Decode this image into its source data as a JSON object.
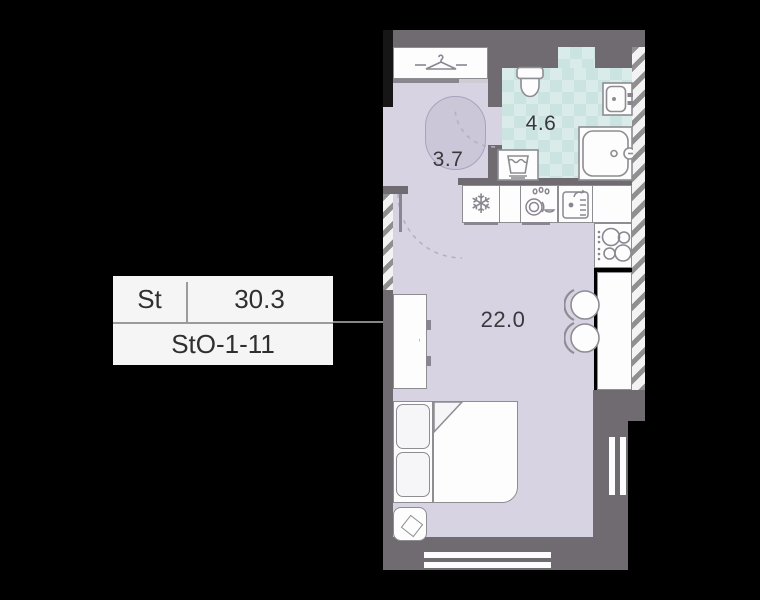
{
  "unit_card": {
    "type_label": "St",
    "area_value": "30.3",
    "unit_id": "StO-1-11"
  },
  "plan": {
    "rooms": [
      {
        "name": "hallway",
        "area_label": "3.7"
      },
      {
        "name": "bathroom",
        "area_label": "4.6"
      },
      {
        "name": "living-room",
        "area_label": "22.0"
      }
    ]
  },
  "icons": {
    "snowflake_glyph": "❄",
    "names": [
      "hanger-icon",
      "snowflake-icon",
      "dishwasher-icon",
      "kitchen-sink-icon",
      "toilet-icon",
      "bath-sink-icon",
      "bathtub-icon",
      "washing-machine-icon",
      "stove-burners-icon",
      "chair-icon",
      "rug",
      "bed",
      "pillow",
      "nightstand",
      "window"
    ]
  },
  "colors": {
    "floor": "#d7d3e3",
    "tile": "#d9ecea",
    "tile_check": "#cbe4e1",
    "wall_gray": "#6f6b70",
    "wall_black": "#161616",
    "outline": "#8d8d92",
    "card_bg": "#f5f5f5",
    "text": "#333337",
    "background": "#000000"
  }
}
